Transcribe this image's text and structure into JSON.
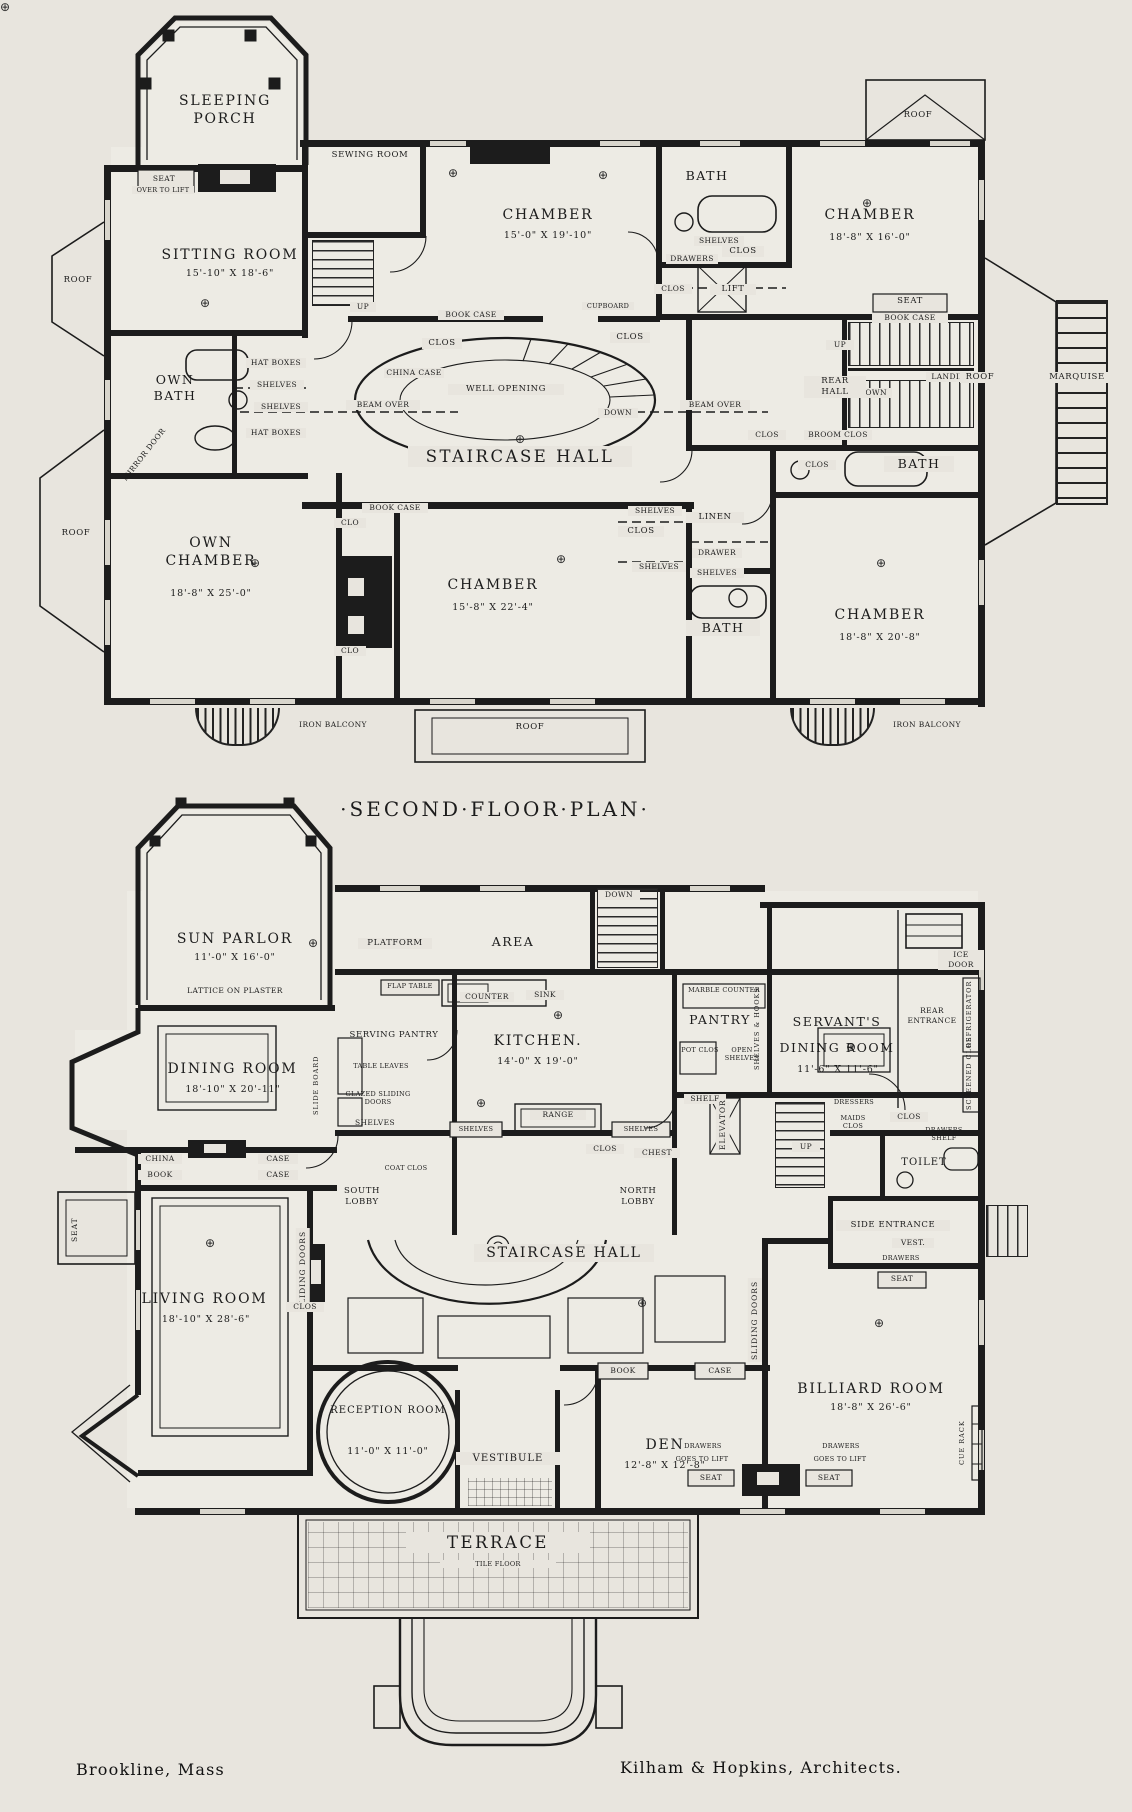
{
  "page": {
    "plan_title": "·Second·Floor·Plan·",
    "title_block_city": "Brookline, Mass",
    "title_block_architects": "Kilham & Hopkins, Architects."
  },
  "colors": {
    "paper": "#e8e5de",
    "ink": "#1c1c1c"
  },
  "common": {
    "roof": "Roof",
    "up": "Up",
    "down": "Down",
    "clos": "Clos",
    "clo": "Clo",
    "shelves": "Shelves",
    "shelf": "Shelf",
    "seat": "Seat",
    "book_case": "Book Case",
    "china_case": "China Case",
    "beam_over": "Beam Over",
    "bath": "Bath",
    "drawers": "Drawers",
    "drawer": "Drawer",
    "chamber": "Chamber",
    "book": "Book",
    "case": "Case",
    "china": "China",
    "sliding_doors": "Sliding Doors",
    "iron_balcony": "Iron Balcony",
    "goes_to_lift": "Goes to Lift",
    "sink": "Sink",
    "counter": "Counter",
    "broom_clos": "Broom Clos",
    "coat_clos": "Coat Clos",
    "staircase_hall": "Staircase Hall",
    "dining_room": "Dining Room",
    "light_symbol": "⊕"
  },
  "floor2": {
    "sleeping_porch": "Sleeping Porch",
    "seat_note": "Over to Lift",
    "sewing_room": "Sewing Room",
    "sitting_room": "Sitting Room",
    "sitting_room_dims": "15'-10\" x 18'-6\"",
    "chamber1_dims": "15'-0\" x 19'-10\"",
    "chamber2_dims": "18'-8\" x 16'-0\"",
    "chamber3_dims": "15'-8\" x 22'-4\"",
    "chamber4_dims": "18'-8\" x 20'-8\"",
    "own_bath": "Own Bath",
    "own_chamber": "Own Chamber",
    "own_chamber_dims": "18'-8\" x 25'-0\"",
    "hat_boxes": "Hat Boxes",
    "mirror_door": "Mirror Door",
    "well_opening": "Well Opening",
    "lift": "Lift",
    "cupboard": "Cupboard",
    "rear_hall": "Rear Hall",
    "landing": "Landing",
    "marquise": "Marquise",
    "linen": "Linen"
  },
  "floor1": {
    "sun_parlor": "Sun Parlor",
    "sun_parlor_dims": "11'-0\" x 16'-0\"",
    "lattice": "Lattice on Plaster",
    "platform": "Platform",
    "area": "Area",
    "flap_table": "Flap Table",
    "serving_pantry": "Serving Pantry",
    "table_leaves": "Table Leaves",
    "slide_board": "Slide Board",
    "glazed_doors": "Glazed Sliding Doors",
    "kitchen": "Kitchen.",
    "kitchen_dims": "14'-0\" x 19'-0\"",
    "range": "Range",
    "marble_counter": "Marble Counter",
    "pantry": "Pantry",
    "shelves_hooks": "Shelves & Hooks",
    "pot_clos": "Pot Clos",
    "open_shelves": "Open Shelves",
    "servants": "Servant's",
    "servants_dims": "11'-6\" x 11'-6\"",
    "rear_entrance": "Rear Entrance",
    "ice_door": "Ice Door",
    "refrigerator": "Refrigerator",
    "screened_clos": "Screened Clos",
    "elevator": "Elevator",
    "chest": "Chest",
    "maids_clos": "Maids Clos",
    "dressers": "Dressers",
    "drawers_shelf": "Drawers Shelf",
    "toilet": "Toilet",
    "side_entrance": "Side Entrance",
    "vest": "Vest.",
    "south_lobby": "South Lobby",
    "north_lobby": "North Lobby",
    "dining_room_dims": "18'-10\" x 20'-11\"",
    "living_room": "Living Room",
    "living_room_dims": "18'-10\" x 28'-6\"",
    "reception_room": "Reception Room",
    "reception_dims": "11'-0\" x 11'-0\"",
    "vestibule": "Vestibule",
    "den": "Den",
    "den_dims": "12'-8\" x 12'-8\"",
    "billiard_room": "Billiard Room",
    "billiard_dims": "18'-8\" x 26'-6\"",
    "cue_rack": "Cue Rack",
    "terrace": "Terrace",
    "tile_floor": "Tile Floor"
  }
}
